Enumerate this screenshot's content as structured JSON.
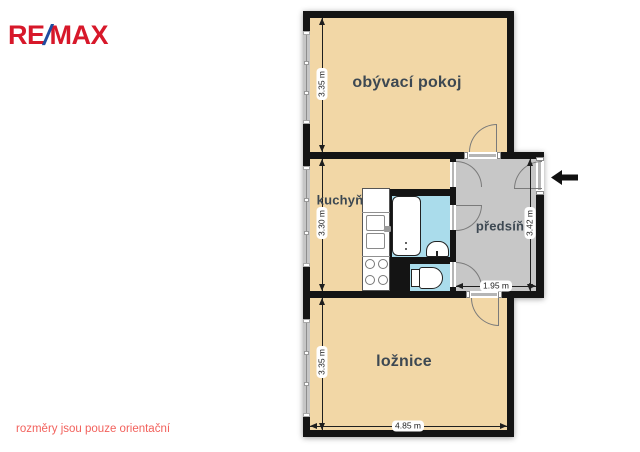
{
  "header": {
    "logo": {
      "re": "RE",
      "slash": "/",
      "max": "MAX"
    }
  },
  "footer": {
    "disclaimer": "rozměry jsou pouze orientační"
  },
  "plan": {
    "rooms": {
      "living": {
        "label": "obývací pokoj",
        "height_dim": "3.35 m"
      },
      "kitchen": {
        "label": "kuchyň",
        "height_dim": "3.30 m"
      },
      "hall": {
        "label": "předsíň",
        "height_dim": "3.42 m",
        "width_dim": "1.95 m"
      },
      "bedroom": {
        "label": "ložnice",
        "height_dim": "3.35 m",
        "width_dim": "4.85 m"
      }
    },
    "fixtures": [
      "bathtub",
      "washbasin",
      "toilet",
      "kitchen-sink",
      "stove-4-burner",
      "kitchen-counter"
    ],
    "windows_count": 3,
    "entrance": {
      "arrow_direction": "left"
    }
  },
  "colors": {
    "floor": "#F2D7A6",
    "hall_floor": "#C7C7C7",
    "wet_floor": "#AADCEB",
    "wall": "#141414",
    "room_label": "#3D4852",
    "dim": "#1E1E1E",
    "remax_red": "#D7182A",
    "remax_blue": "#1F4CA0",
    "disclaimer": "#F2615C"
  }
}
